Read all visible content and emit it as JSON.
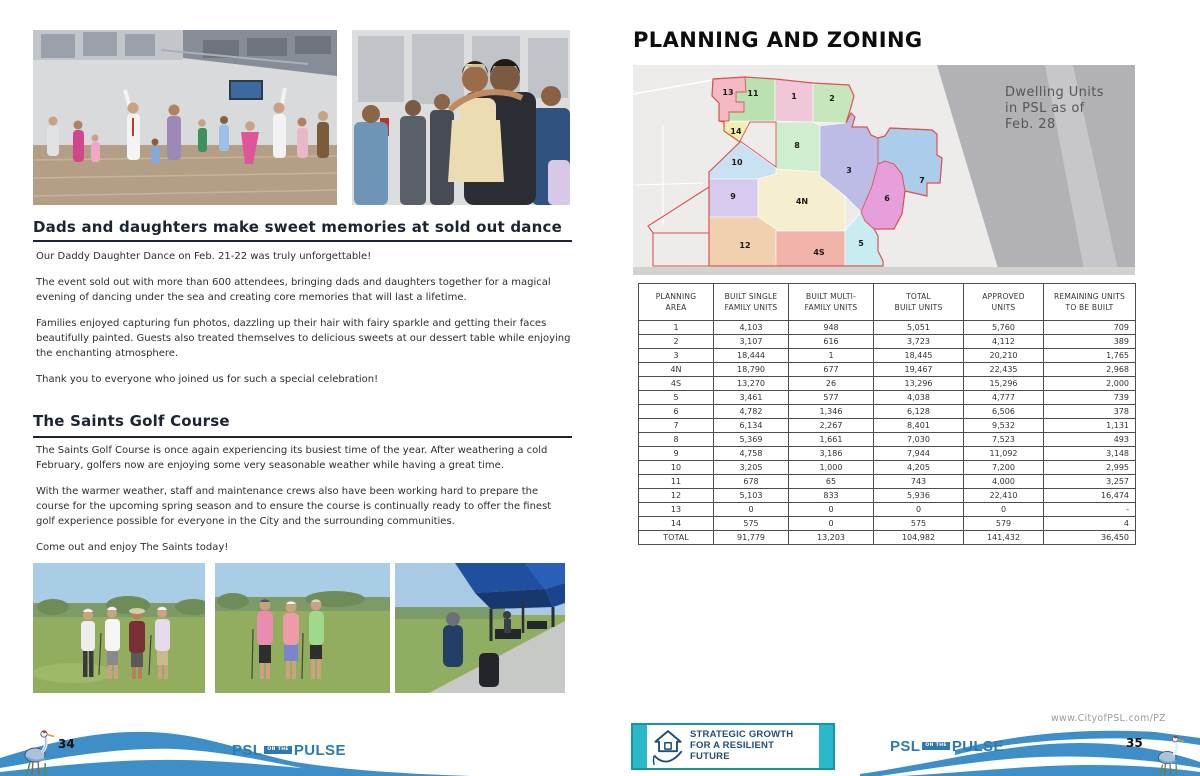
{
  "left_page": {
    "page_number": "34",
    "dance": {
      "title": "Dads and daughters make sweet memories at sold out dance",
      "paragraphs": [
        "Our Daddy Daughter Dance on Feb. 21-22 was truly unforgettable!",
        "The event sold out with more than 600 attendees, bringing dads and daughters together for a magical evening of dancing under the sea and creating core memories that will last a lifetime.",
        "Families enjoyed capturing fun photos, dazzling up their hair with fairy sparkle and getting their faces beautifully painted. Guests also treated themselves to delicious sweets at our dessert table while enjoying the enchanting atmosphere.",
        "Thank you to everyone who joined us for such a special celebration!"
      ]
    },
    "golf": {
      "title": "The Saints Golf Course",
      "paragraphs": [
        "The Saints Golf Course is once again experiencing its busiest time of the year. After weathering a cold February, golfers now are enjoying some very seasonable weather while having a great time.",
        "With the warmer weather, staff and maintenance crews also have been working hard to prepare the course for the upcoming spring season and to ensure the course is continually ready to offer the finest golf experience possible for everyone in the City and the surrounding communities.",
        "Come out and enjoy The Saints today!"
      ]
    }
  },
  "right_page": {
    "page_number": "35",
    "title": "PLANNING AND ZONING",
    "url": "www.CityofPSL.com/PZ",
    "badge": {
      "lines": [
        "STRATEGIC GROWTH",
        "FOR A RESILIENT",
        "FUTURE"
      ]
    },
    "map": {
      "caption_lines": [
        "Dwelling Units",
        "in PSL as of",
        "Feb. 28"
      ],
      "areas": [
        {
          "id": "1",
          "label": "1",
          "color": "#EFC7D9"
        },
        {
          "id": "2",
          "label": "2",
          "color": "#C7E6BC"
        },
        {
          "id": "3",
          "label": "3",
          "color": "#BDBCE7"
        },
        {
          "id": "4N",
          "label": "4N",
          "color": "#F6EFCF"
        },
        {
          "id": "4S",
          "label": "4S",
          "color": "#F2B3AB"
        },
        {
          "id": "5",
          "label": "5",
          "color": "#C7ECF2"
        },
        {
          "id": "6",
          "label": "6",
          "color": "#E79FDB"
        },
        {
          "id": "7",
          "label": "7",
          "color": "#ACCDEA"
        },
        {
          "id": "8",
          "label": "8",
          "color": "#CFEDCF"
        },
        {
          "id": "9",
          "label": "9",
          "color": "#D7CAEF"
        },
        {
          "id": "10",
          "label": "10",
          "color": "#CAE1F3"
        },
        {
          "id": "11",
          "label": "11",
          "color": "#BAE2B0"
        },
        {
          "id": "12",
          "label": "12",
          "color": "#F1D0B0"
        },
        {
          "id": "13",
          "label": "13",
          "color": "#F4BAC4"
        },
        {
          "id": "14",
          "label": "14",
          "color": "#F5EDAF"
        }
      ]
    },
    "table": {
      "headers": [
        [
          "PLANNING",
          "AREA"
        ],
        [
          "BUILT SINGLE",
          "FAMILY UNITS"
        ],
        [
          "BUILT MULTI-",
          "FAMILY UNITS"
        ],
        [
          "TOTAL",
          "BUILT UNITS"
        ],
        [
          "APPROVED",
          "UNITS"
        ],
        [
          "REMAINING UNITS",
          "TO BE BUILT"
        ]
      ],
      "rows": [
        [
          "1",
          "4,103",
          "948",
          "5,051",
          "5,760",
          "709"
        ],
        [
          "2",
          "3,107",
          "616",
          "3,723",
          "4,112",
          "389"
        ],
        [
          "3",
          "18,444",
          "1",
          "18,445",
          "20,210",
          "1,765"
        ],
        [
          "4N",
          "18,790",
          "677",
          "19,467",
          "22,435",
          "2,968"
        ],
        [
          "4S",
          "13,270",
          "26",
          "13,296",
          "15,296",
          "2,000"
        ],
        [
          "5",
          "3,461",
          "577",
          "4,038",
          "4,777",
          "739"
        ],
        [
          "6",
          "4,782",
          "1,346",
          "6,128",
          "6,506",
          "378"
        ],
        [
          "7",
          "6,134",
          "2,267",
          "8,401",
          "9,532",
          "1,131"
        ],
        [
          "8",
          "5,369",
          "1,661",
          "7,030",
          "7,523",
          "493"
        ],
        [
          "9",
          "4,758",
          "3,186",
          "7,944",
          "11,092",
          "3,148"
        ],
        [
          "10",
          "3,205",
          "1,000",
          "4,205",
          "7,200",
          "2,995"
        ],
        [
          "11",
          "678",
          "65",
          "743",
          "4,000",
          "3,257"
        ],
        [
          "12",
          "5,103",
          "833",
          "5,936",
          "22,410",
          "16,474"
        ],
        [
          "13",
          "0",
          "0",
          "0",
          "0",
          "-"
        ],
        [
          "14",
          "575",
          "0",
          "575",
          "579",
          "4"
        ]
      ],
      "total_row": [
        "TOTAL",
        "91,779",
        "13,203",
        "104,982",
        "141,432",
        "36,450"
      ]
    }
  },
  "footer": {
    "logo": {
      "psl": "PSL",
      "on_the": "ON THE",
      "pulse": "PULSE"
    }
  },
  "colors": {
    "wave_blue": "#3E8FC8",
    "logo_blue": "#2C79B4",
    "teal": "#2BB8C9",
    "navy": "#1E4E79",
    "map_red": "#D9534F"
  }
}
